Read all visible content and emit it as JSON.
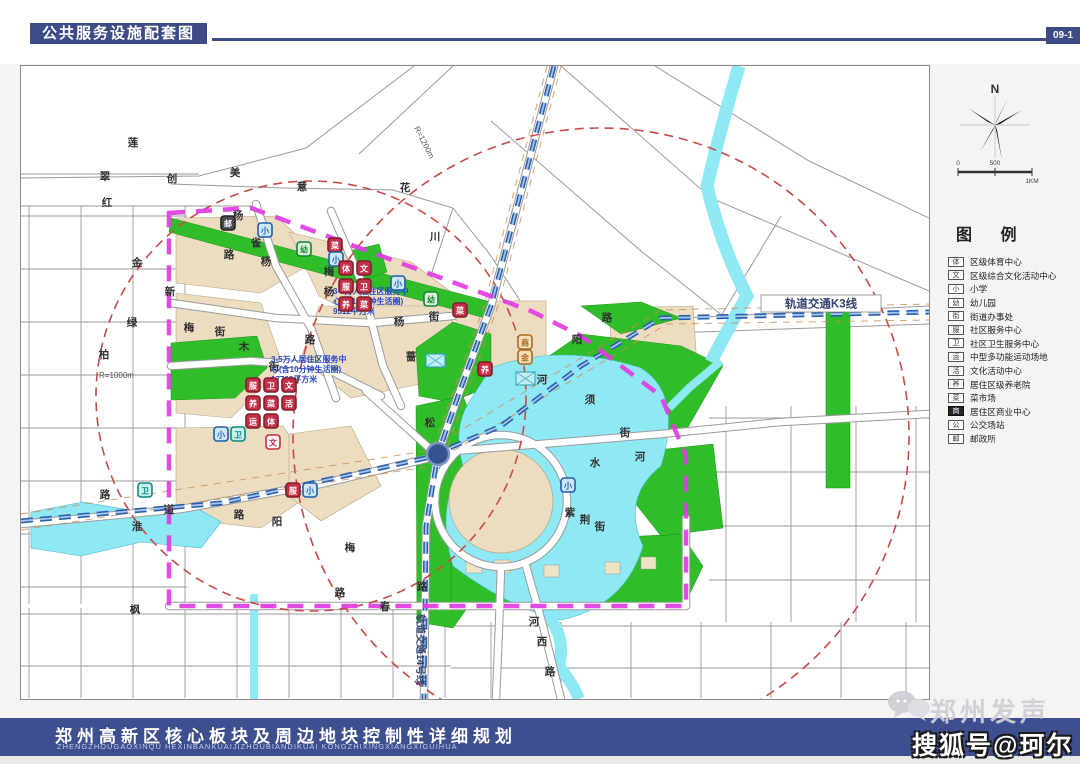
{
  "header": {
    "title": "公共服务设施配套图",
    "page_code": "09-1"
  },
  "footer": {
    "title": "郑州高新区核心板块及周边地块控制性详细规划",
    "subtitle": "ZHENGZHOUGAOXINQU HEXINBANKUAIJIZHOUBIANDIKUAI KONGZHIXINGXIANGXIGUIHUA"
  },
  "watermark": {
    "brand": "郑州发声",
    "account": "搜狐号@珂尔"
  },
  "sidebar": {
    "north_label": "N",
    "scale_labels": [
      "0",
      "500",
      "1KM"
    ],
    "legend_title": "图 例",
    "legend_items": [
      {
        "glyph": "体",
        "label": "区级体育中心",
        "dark": false
      },
      {
        "glyph": "文",
        "label": "区级综合文化活动中心",
        "dark": false
      },
      {
        "glyph": "小",
        "label": "小学",
        "dark": false
      },
      {
        "glyph": "幼",
        "label": "幼儿园",
        "dark": false
      },
      {
        "glyph": "街",
        "label": "街道办事处",
        "dark": false
      },
      {
        "glyph": "服",
        "label": "社区服务中心",
        "dark": false
      },
      {
        "glyph": "卫",
        "label": "社区卫生服务中心",
        "dark": false
      },
      {
        "glyph": "运",
        "label": "中型多功能运动场地",
        "dark": false
      },
      {
        "glyph": "活",
        "label": "文化活动中心",
        "dark": false
      },
      {
        "glyph": "养",
        "label": "居住区级养老院",
        "dark": false
      },
      {
        "glyph": "菜",
        "label": "菜市场",
        "dark": false
      },
      {
        "glyph": "商",
        "label": "居住区商业中心",
        "dark": true
      },
      {
        "glyph": "公",
        "label": "公交场站",
        "dark": false
      },
      {
        "glyph": "邮",
        "label": "邮政所",
        "dark": false
      }
    ]
  },
  "map": {
    "metro_k3_label": "轨道交通K3线",
    "metro_14_label": "轨道交通14号线",
    "radius_labels": [
      {
        "text": "R=1000m",
        "x": 78,
        "y": 312,
        "rot": 0
      },
      {
        "text": "R=1200m",
        "x": 393,
        "y": 62,
        "rot": 63
      }
    ],
    "annotations": [
      {
        "x": 312,
        "y": 228,
        "lines": [
          "3-5万人居住区服务中",
          "心(含10分钟生活圈)",
          "9512平方米"
        ]
      },
      {
        "x": 250,
        "y": 296,
        "lines": [
          "3-5万人居住区服务中",
          "心(含10分钟生活圈)",
          "17768平方米"
        ]
      }
    ],
    "street_labels": [
      {
        "t": "莲",
        "x": 112,
        "y": 80
      },
      {
        "t": "翠",
        "x": 84,
        "y": 114
      },
      {
        "t": "红",
        "x": 86,
        "y": 140
      },
      {
        "t": "创",
        "x": 151,
        "y": 116
      },
      {
        "t": "美",
        "x": 214,
        "y": 110
      },
      {
        "t": "意",
        "x": 281,
        "y": 124
      },
      {
        "t": "花",
        "x": 384,
        "y": 125
      },
      {
        "t": "川",
        "x": 414,
        "y": 174
      },
      {
        "t": "金",
        "x": 116,
        "y": 200
      },
      {
        "t": "新",
        "x": 149,
        "y": 229
      },
      {
        "t": "绿",
        "x": 111,
        "y": 260
      },
      {
        "t": "柏",
        "x": 83,
        "y": 292
      },
      {
        "t": "杨",
        "x": 217,
        "y": 153
      },
      {
        "t": "雀",
        "x": 235,
        "y": 180
      },
      {
        "t": "路",
        "x": 208,
        "y": 192
      },
      {
        "t": "杨",
        "x": 245,
        "y": 199
      },
      {
        "t": "梅",
        "x": 308,
        "y": 209
      },
      {
        "t": "杨",
        "x": 308,
        "y": 229
      },
      {
        "t": "梅",
        "x": 168,
        "y": 265
      },
      {
        "t": "街",
        "x": 199,
        "y": 269
      },
      {
        "t": "木",
        "x": 223,
        "y": 284
      },
      {
        "t": "街",
        "x": 253,
        "y": 304
      },
      {
        "t": "路",
        "x": 289,
        "y": 277
      },
      {
        "t": "杨",
        "x": 378,
        "y": 259
      },
      {
        "t": "街",
        "x": 413,
        "y": 254
      },
      {
        "t": "蔷",
        "x": 390,
        "y": 294
      },
      {
        "t": "松",
        "x": 409,
        "y": 360
      },
      {
        "t": "路",
        "x": 586,
        "y": 255
      },
      {
        "t": "阳",
        "x": 556,
        "y": 277
      },
      {
        "t": "河",
        "x": 521,
        "y": 317
      },
      {
        "t": "须",
        "x": 569,
        "y": 337
      },
      {
        "t": "街",
        "x": 604,
        "y": 370
      },
      {
        "t": "水",
        "x": 574,
        "y": 400
      },
      {
        "t": "河",
        "x": 619,
        "y": 394
      },
      {
        "t": "紫",
        "x": 549,
        "y": 450
      },
      {
        "t": "荆",
        "x": 564,
        "y": 457
      },
      {
        "t": "街",
        "x": 579,
        "y": 464
      },
      {
        "t": "淮",
        "x": 116,
        "y": 464
      },
      {
        "t": "阳",
        "x": 256,
        "y": 459
      },
      {
        "t": "路",
        "x": 218,
        "y": 452
      },
      {
        "t": "道",
        "x": 148,
        "y": 447
      },
      {
        "t": "路",
        "x": 84,
        "y": 432
      },
      {
        "t": "枫",
        "x": 114,
        "y": 547
      },
      {
        "t": "梅",
        "x": 329,
        "y": 485
      },
      {
        "t": "路",
        "x": 319,
        "y": 530
      },
      {
        "t": "春",
        "x": 364,
        "y": 544
      },
      {
        "t": "路",
        "x": 401,
        "y": 524
      },
      {
        "t": "河",
        "x": 513,
        "y": 559
      },
      {
        "t": "西",
        "x": 521,
        "y": 579
      },
      {
        "t": "路",
        "x": 529,
        "y": 609
      }
    ],
    "icons": [
      {
        "type": "gray",
        "glyph": "邮",
        "x": 200,
        "y": 150
      },
      {
        "type": "blue",
        "glyph": "小",
        "x": 237,
        "y": 157
      },
      {
        "type": "red",
        "glyph": "菜",
        "x": 307,
        "y": 172
      },
      {
        "type": "blue",
        "glyph": "小",
        "x": 308,
        "y": 186
      },
      {
        "type": "green",
        "glyph": "幼",
        "x": 276,
        "y": 176
      },
      {
        "type": "red",
        "glyph": "体",
        "x": 318,
        "y": 195
      },
      {
        "type": "red",
        "glyph": "文",
        "x": 336,
        "y": 195
      },
      {
        "type": "red",
        "glyph": "服",
        "x": 318,
        "y": 213
      },
      {
        "type": "red",
        "glyph": "卫",
        "x": 336,
        "y": 213
      },
      {
        "type": "red",
        "glyph": "养",
        "x": 318,
        "y": 231
      },
      {
        "type": "red",
        "glyph": "菜",
        "x": 336,
        "y": 231
      },
      {
        "type": "blue",
        "glyph": "小",
        "x": 370,
        "y": 210
      },
      {
        "type": "green",
        "glyph": "幼",
        "x": 403,
        "y": 226
      },
      {
        "type": "red",
        "glyph": "菜",
        "x": 432,
        "y": 237
      },
      {
        "type": "red",
        "glyph": "服",
        "x": 225,
        "y": 312
      },
      {
        "type": "red",
        "glyph": "卫",
        "x": 243,
        "y": 312
      },
      {
        "type": "red",
        "glyph": "文",
        "x": 261,
        "y": 312
      },
      {
        "type": "red",
        "glyph": "养",
        "x": 225,
        "y": 330
      },
      {
        "type": "red",
        "glyph": "菜",
        "x": 243,
        "y": 330
      },
      {
        "type": "red",
        "glyph": "活",
        "x": 261,
        "y": 330
      },
      {
        "type": "red",
        "glyph": "运",
        "x": 225,
        "y": 348
      },
      {
        "type": "red",
        "glyph": "体",
        "x": 243,
        "y": 348
      },
      {
        "type": "red-outline",
        "glyph": "文",
        "x": 245,
        "y": 369
      },
      {
        "type": "blue",
        "glyph": "小",
        "x": 193,
        "y": 361
      },
      {
        "type": "teal",
        "glyph": "卫",
        "x": 210,
        "y": 361
      },
      {
        "type": "red",
        "glyph": "服",
        "x": 265,
        "y": 417
      },
      {
        "type": "blue",
        "glyph": "小",
        "x": 282,
        "y": 417
      },
      {
        "type": "teal",
        "glyph": "卫",
        "x": 117,
        "y": 417
      },
      {
        "type": "orange",
        "glyph": "商",
        "x": 497,
        "y": 269
      },
      {
        "type": "orange",
        "glyph": "金",
        "x": 497,
        "y": 284
      },
      {
        "type": "red",
        "glyph": "养",
        "x": 457,
        "y": 296
      },
      {
        "type": "blue",
        "glyph": "小",
        "x": 540,
        "y": 412
      },
      {
        "type": "bus",
        "glyph": "",
        "x": 495,
        "y": 306
      },
      {
        "type": "bus",
        "glyph": "",
        "x": 405,
        "y": 288
      }
    ]
  },
  "colors": {
    "navy": "#3d4c87",
    "tan": "#ecdcc0",
    "green": "#2fbe2a",
    "water": "#8ee9f4",
    "boundary_magenta": "#e23be2",
    "radius_red": "#c84848",
    "metro_blue": "#2a5fae",
    "annotation_blue": "#2746c8"
  }
}
